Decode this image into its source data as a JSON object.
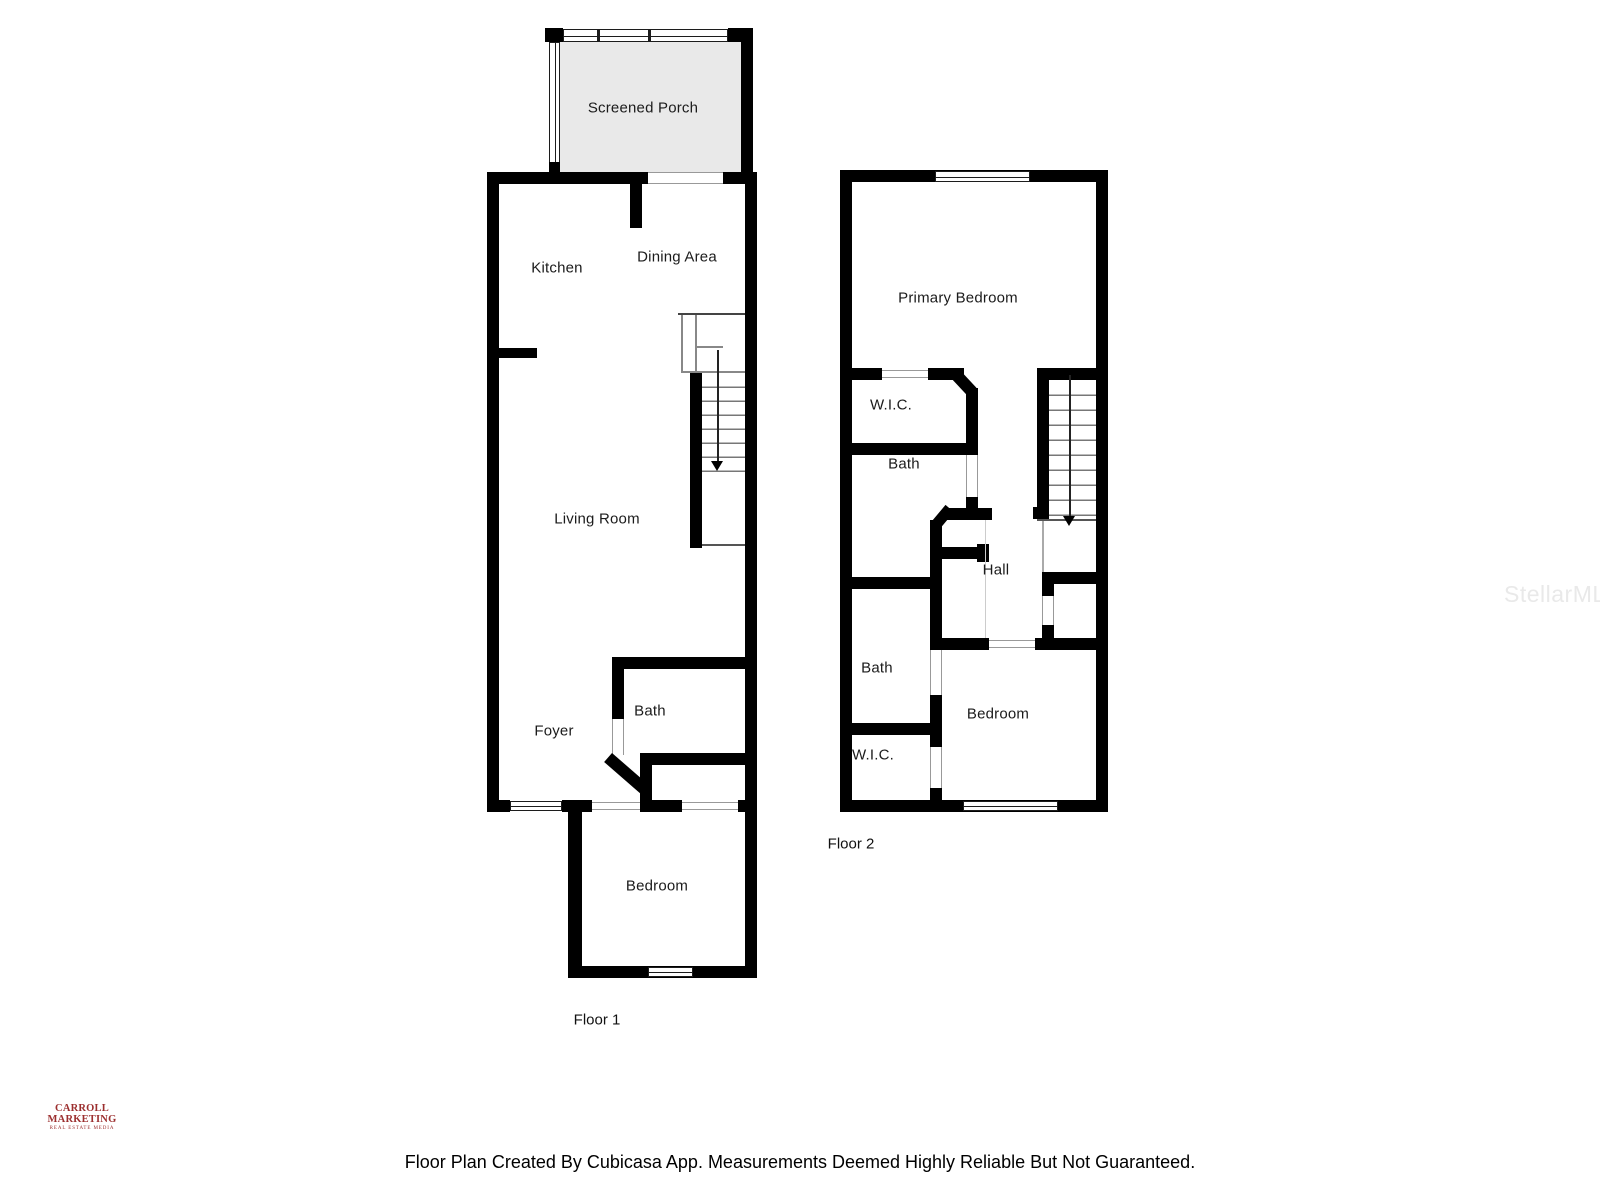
{
  "floor1": {
    "label": "Floor 1",
    "rooms": {
      "screened_porch": "Screened Porch",
      "kitchen": "Kitchen",
      "dining_area": "Dining Area",
      "living_room": "Living Room",
      "bath": "Bath",
      "foyer": "Foyer",
      "bedroom": "Bedroom"
    }
  },
  "floor2": {
    "label": "Floor 2",
    "rooms": {
      "primary_bedroom": "Primary Bedroom",
      "wic_upper": "W.I.C.",
      "bath_upper": "Bath",
      "hall": "Hall",
      "bath_lower": "Bath",
      "bedroom": "Bedroom",
      "wic_lower": "W.I.C."
    }
  },
  "branding": {
    "logo_title": "CARROLL MARKETING",
    "logo_subtitle": "REAL ESTATE MEDIA",
    "logo_color": "#9c2f2f",
    "watermark": "StellarMLS",
    "watermark_color": "#e9e9e9"
  },
  "footer": {
    "disclaimer": "Floor Plan Created By Cubicasa App. Measurements Deemed Highly Reliable But Not Guaranteed."
  },
  "colors": {
    "wall": "#000000",
    "porch_fill": "#e9e9e9",
    "opening_line": "#999999"
  }
}
